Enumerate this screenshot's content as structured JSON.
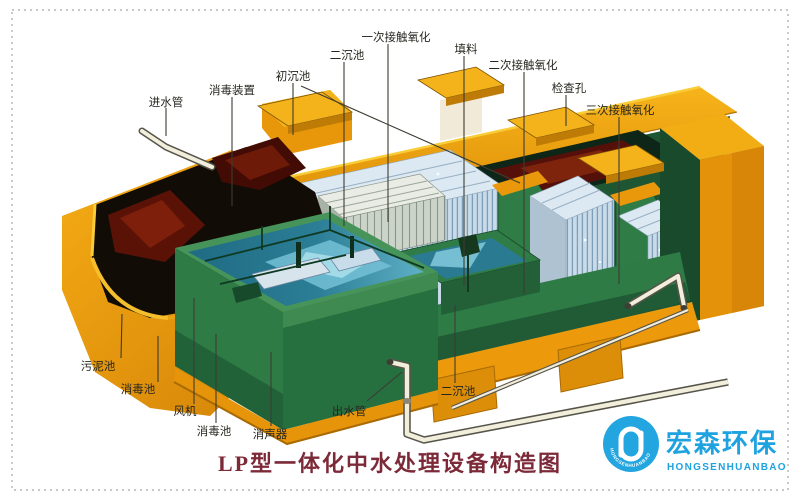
{
  "diagram": {
    "title": "LP型一体化中水处理设备构造图",
    "labels": [
      {
        "text": "进水管",
        "x": 166,
        "y": 102,
        "lines": [
          [
            166,
            108,
            166,
            136
          ]
        ]
      },
      {
        "text": "消毒装置",
        "x": 232,
        "y": 90,
        "lines": [
          [
            232,
            97,
            232,
            206
          ]
        ]
      },
      {
        "text": "初沉池",
        "x": 293,
        "y": 76,
        "lines": [
          [
            293,
            83,
            293,
            135
          ],
          [
            301,
            86,
            520,
            183
          ]
        ]
      },
      {
        "text": "二沉池",
        "x": 347,
        "y": 55,
        "lines": [
          [
            344,
            62,
            344,
            226
          ]
        ]
      },
      {
        "text": "一次接触氧化",
        "x": 396,
        "y": 37,
        "lines": [
          [
            388,
            44,
            388,
            222
          ]
        ]
      },
      {
        "text": "填料",
        "x": 466,
        "y": 49,
        "lines": [
          [
            464,
            56,
            464,
            286
          ]
        ]
      },
      {
        "text": "二次接触氧化",
        "x": 523,
        "y": 65,
        "lines": [
          [
            524,
            72,
            524,
            294
          ]
        ]
      },
      {
        "text": "检查孔",
        "x": 569,
        "y": 88,
        "lines": [
          [
            566,
            95,
            566,
            126
          ]
        ]
      },
      {
        "text": "三次接触氧化",
        "x": 620,
        "y": 110,
        "lines": [
          [
            619,
            117,
            619,
            284
          ]
        ]
      },
      {
        "text": "污泥池",
        "x": 98,
        "y": 366,
        "lines": [
          [
            121,
            358,
            122,
            314
          ]
        ]
      },
      {
        "text": "消毒池",
        "x": 138,
        "y": 389,
        "lines": [
          [
            158,
            382,
            158,
            336
          ]
        ]
      },
      {
        "text": "风机",
        "x": 185,
        "y": 411,
        "lines": [
          [
            194,
            404,
            194,
            298
          ]
        ]
      },
      {
        "text": "消毒池",
        "x": 214,
        "y": 431,
        "lines": [
          [
            216,
            423,
            216,
            334
          ]
        ]
      },
      {
        "text": "消声器",
        "x": 270,
        "y": 434,
        "lines": [
          [
            271,
            426,
            271,
            352
          ]
        ]
      },
      {
        "text": "出水管",
        "x": 349,
        "y": 411,
        "lines": [
          [
            367,
            401,
            402,
            372
          ]
        ]
      },
      {
        "text": "二沉池",
        "x": 458,
        "y": 391,
        "lines": [
          [
            455,
            383,
            455,
            305
          ]
        ]
      }
    ]
  },
  "logo": {
    "cn": "宏森环保",
    "en": "HONGSENHUANBAO",
    "badge": "HONGSENHUANBAO",
    "blue": "#1ea3e0"
  },
  "colors": {
    "shell_orange": "#efa00d",
    "wall_green": "#2e7b45",
    "water_teal": "#2b7e95",
    "filler_blue": "#cbdce9",
    "sludge_red": "#5a1207",
    "title_maroon": "#7d2a38",
    "label_ink": "#26261f"
  }
}
